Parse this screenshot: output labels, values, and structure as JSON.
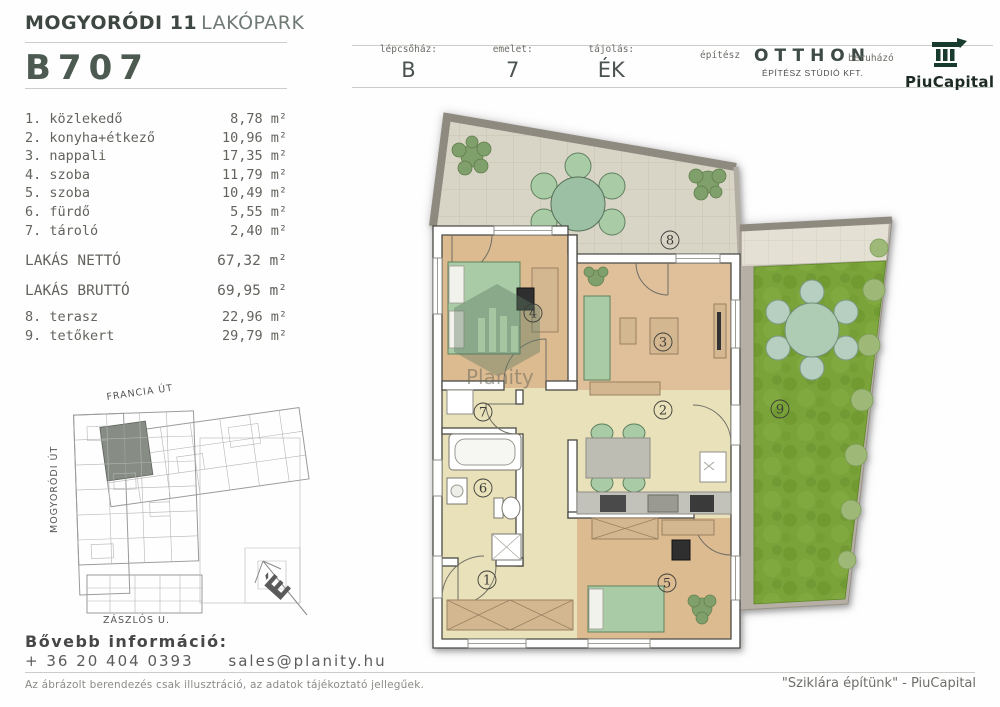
{
  "header": {
    "project_title_bold": "MOGYORÓDI 11",
    "project_title_light": "LAKÓPARK",
    "unit_id": "B707",
    "fields": [
      {
        "label": "lépcsőház:",
        "value": "B"
      },
      {
        "label": "emelet:",
        "value": "7"
      },
      {
        "label": "tájolás:",
        "value": "ÉK"
      }
    ],
    "architect_label": "építész",
    "architect_name": "OTTHON",
    "architect_sub": "ÉPÍTÉSZ STÚDIÓ KFT.",
    "developer_label": "beruházó",
    "developer_name": "PiuCapital"
  },
  "rooms": [
    {
      "num": "1.",
      "name": "közlekedő",
      "area": "8,78"
    },
    {
      "num": "2.",
      "name": "konyha+étkező",
      "area": "10,96"
    },
    {
      "num": "3.",
      "name": "nappali",
      "area": "17,35"
    },
    {
      "num": "4.",
      "name": "szoba",
      "area": "11,79"
    },
    {
      "num": "5.",
      "name": "szoba",
      "area": "10,49"
    },
    {
      "num": "6.",
      "name": "fürdő",
      "area": "5,55"
    },
    {
      "num": "7.",
      "name": "tároló",
      "area": "2,40"
    }
  ],
  "totals": [
    {
      "label": "LAKÁS NETTÓ",
      "area": "67,32"
    },
    {
      "label": "LAKÁS BRUTTÓ",
      "area": "69,95"
    }
  ],
  "outdoor": [
    {
      "num": "8.",
      "name": "terasz",
      "area": "22,96"
    },
    {
      "num": "9.",
      "name": "tetőkert",
      "area": "29,79"
    }
  ],
  "area_unit": "m²",
  "plan": {
    "room_labels": [
      "1",
      "2",
      "3",
      "4",
      "5",
      "6",
      "7",
      "8",
      "9"
    ],
    "watermark": "Planity"
  },
  "site_map": {
    "street_top": "FRANCIA ÚT",
    "street_left": "MOGYORÓDI ÚT",
    "street_bottom": "ZÁSZLÓS U.",
    "compass": "É"
  },
  "contact": {
    "heading": "Bővebb információ:",
    "phone": "+ 36 20 404 0393",
    "email": "sales@planity.hu"
  },
  "footer": {
    "disclaimer": "Az ábrázolt berendezés csak illusztráció, az adatok tájékoztató jellegűek.",
    "slogan": "\"Sziklára építünk\" - PiuCapital"
  },
  "colors": {
    "title_dark": "#3e4742",
    "unit_id": "#4c5a52",
    "grass": "#7aa339",
    "furniture_green": "#a9cba6",
    "wood_floor": "#ddbb90",
    "beige_floor": "#e9e1ba",
    "terrace_tile": "#d9d5c6",
    "logo_green": "#183b2d"
  }
}
